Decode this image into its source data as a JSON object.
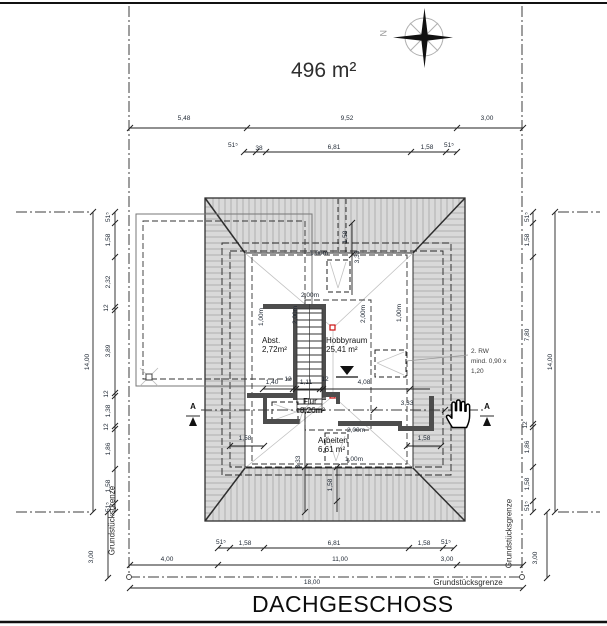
{
  "header": {
    "area_label": "496 m²",
    "north_letter": "N"
  },
  "title": "DACHGESCHOSS",
  "boundary": {
    "left": "Grundstücksgrenze",
    "right": "Grundstücksgrenze",
    "bottom": "Grundstücksgrenze"
  },
  "rooms": {
    "abst": {
      "name": "Abst.",
      "area": "2,72m²"
    },
    "hobbyraum": {
      "name": "Hobbyraum",
      "area": "25,41 m²"
    },
    "flur": {
      "name": "Flur",
      "area": "8,26m²"
    },
    "arbeiten": {
      "name": "Arbeiten",
      "area": "6,61 m²"
    }
  },
  "annotation": {
    "line1": "2. RW",
    "line2": "mind. 0,90 x",
    "line3": "1,20"
  },
  "section": {
    "label": "A"
  },
  "headroom": {
    "one": "1,00m",
    "two": "2,00m"
  },
  "dims": {
    "top_row_outer": [
      "5,48",
      "9,52",
      "3,00"
    ],
    "top_row_inner": [
      "51⁵",
      "38",
      "6,81",
      "1,58",
      "51⁵"
    ],
    "bottom_row_inner": [
      "51⁵",
      "1,58",
      "6,81",
      "1,58",
      "51⁵"
    ],
    "bottom_row_mid": [
      "4,00",
      "11,00",
      "3,00"
    ],
    "bottom_row_total": "18,00",
    "left_col": [
      "51⁵",
      "1,58",
      "2,32",
      "12",
      "3,89",
      "12",
      "1,38",
      "12",
      "1,86",
      "1,58",
      "51⁵"
    ],
    "left_total": "14,00",
    "left_offset": "3,00",
    "right_col": [
      "51⁵",
      "1,58",
      "7,80",
      "12",
      "1,86",
      "1,58",
      "51⁵"
    ],
    "right_total": "14,00",
    "right_offset": "3,00",
    "stair_row": [
      "1,40",
      "12",
      "1,11",
      "12",
      "4,08"
    ],
    "flur_width": "3,33",
    "eave_left": "1,58",
    "eave_right": "1,58",
    "ridge_top": [
      "1,58",
      "3,33"
    ],
    "ridge_bottom": [
      "3,33",
      "1,58"
    ]
  },
  "colors": {
    "roof_fill": "#d9d9d9",
    "hatch_line": "#a6a6a6",
    "wall": "#4d4d4d",
    "ridge_marker": "#cc1111",
    "dim_text": "#1e2733"
  }
}
